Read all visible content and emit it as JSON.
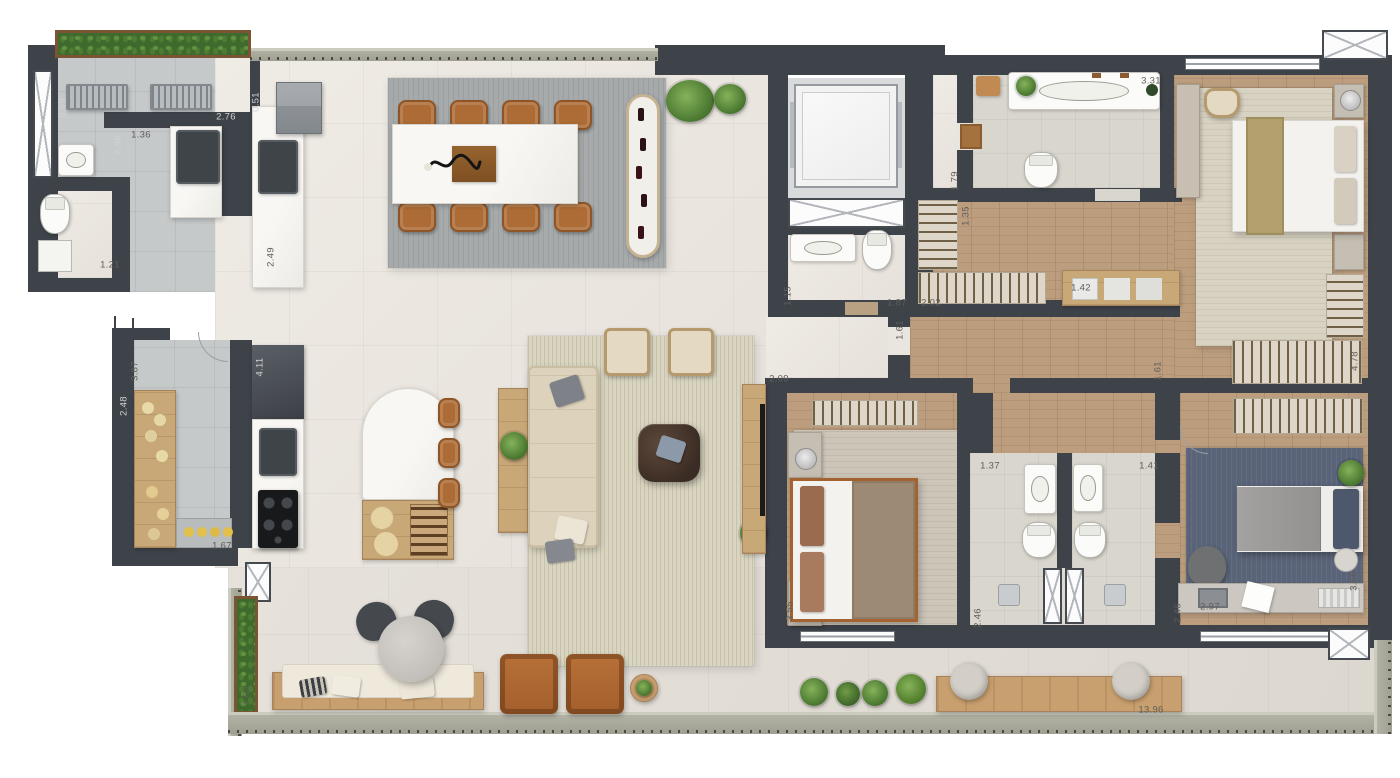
{
  "meta": {
    "type": "apartment-floor-plan-render",
    "view": "top-down-furnished",
    "visible_text_kind": "dimension-annotations-in-meters"
  },
  "palette": {
    "wall": "#3e434a",
    "floor_main_tile": "#eae6e0",
    "floor_service_tile": "#c6c9c9",
    "floor_wood": "#bc9e7f",
    "floor_bath": "#d9d6cd",
    "terrace_tile": "#e2ded7",
    "rug_dining": "#a6aaab",
    "rug_living": "#d9d5c0",
    "rug_bedroom1": "#d8d2c2",
    "rug_bedroom2": "#ccc5b8",
    "rug_bedroom3": "#5a6478",
    "marble": "#f6f5f2",
    "leather_brown": "#b26a33",
    "wood_furniture": "#c9a878",
    "greenery": "#4e7c33",
    "railing": "#a8a89b",
    "appliance_dark": "#3f4449"
  },
  "icons": [
    "planter-icon",
    "drying-rack-icon",
    "laundry-sink-icon",
    "washer-icon",
    "toilet-icon",
    "shower-icon",
    "refrigerator-icon",
    "kitchen-sink-icon",
    "cooktop-icon",
    "pantry-shelf-icon",
    "dining-table-icon",
    "dining-chair-icon",
    "wine-rack-icon",
    "plant-icon",
    "elevator-icon",
    "door-mat-icon",
    "vanity-sink-icon",
    "closet-rack-icon",
    "folded-clothes-icon",
    "double-bed-icon",
    "nightstand-icon",
    "table-lamp-icon",
    "sofa-icon",
    "armchair-icon",
    "coffee-table-icon",
    "console-table-icon",
    "tv-icon",
    "kitchen-island-icon",
    "bar-stool-icon",
    "desk-icon",
    "laptop-icon",
    "lounge-chair-icon",
    "round-table-icon",
    "bench-icon",
    "pouf-icon",
    "side-table-icon",
    "window-icon",
    "shaft-hatch-icon",
    "door-swing-icon",
    "section-cut-icon"
  ],
  "plan": {
    "dimension_labels": [
      {
        "text": "0.69",
        "x": 63,
        "y": 108,
        "rot": -90,
        "tone": "light"
      },
      {
        "text": "2.76",
        "x": 226,
        "y": 117,
        "rot": 0,
        "tone": "light"
      },
      {
        "text": "1.36",
        "x": 141,
        "y": 135,
        "rot": 0,
        "tone": "dark"
      },
      {
        "text": "0.51",
        "x": 256,
        "y": 102,
        "rot": -90,
        "tone": "light"
      },
      {
        "text": "2.06",
        "x": 118,
        "y": 145,
        "rot": -90,
        "tone": "light"
      },
      {
        "text": "2.49",
        "x": 271,
        "y": 257,
        "rot": -90,
        "tone": "dark"
      },
      {
        "text": "1.21",
        "x": 110,
        "y": 265,
        "rot": 0,
        "tone": "dark"
      },
      {
        "text": "3.87",
        "x": 135,
        "y": 371,
        "rot": -90,
        "tone": "dark"
      },
      {
        "text": "2.48",
        "x": 124,
        "y": 406,
        "rot": -90,
        "tone": "light"
      },
      {
        "text": "4.11",
        "x": 260,
        "y": 367,
        "rot": -90,
        "tone": "light"
      },
      {
        "text": "1.67",
        "x": 222,
        "y": 546,
        "rot": 0,
        "tone": "dark"
      },
      {
        "text": "1.79",
        "x": 955,
        "y": 181,
        "rot": -90,
        "tone": "dark"
      },
      {
        "text": "3.31",
        "x": 1151,
        "y": 81,
        "rot": 0,
        "tone": "dark"
      },
      {
        "text": "1.15",
        "x": 788,
        "y": 296,
        "rot": -90,
        "tone": "dark"
      },
      {
        "text": "1.87",
        "x": 897,
        "y": 303,
        "rot": 0,
        "tone": "dark"
      },
      {
        "text": "2.02",
        "x": 931,
        "y": 303,
        "rot": 0,
        "tone": "dark"
      },
      {
        "text": "1.42",
        "x": 1081,
        "y": 288,
        "rot": 0,
        "tone": "dark"
      },
      {
        "text": "1.35",
        "x": 966,
        "y": 216,
        "rot": -90,
        "tone": "dark"
      },
      {
        "text": "1.61",
        "x": 900,
        "y": 330,
        "rot": -90,
        "tone": "dark"
      },
      {
        "text": "2.09",
        "x": 779,
        "y": 379,
        "rot": 0,
        "tone": "dark"
      },
      {
        "text": "1.61",
        "x": 1158,
        "y": 371,
        "rot": -90,
        "tone": "dark"
      },
      {
        "text": "1.37",
        "x": 990,
        "y": 466,
        "rot": 0,
        "tone": "dark"
      },
      {
        "text": "1.41",
        "x": 1149,
        "y": 466,
        "rot": 0,
        "tone": "dark"
      },
      {
        "text": "3.55",
        "x": 790,
        "y": 611,
        "rot": -90,
        "tone": "dark"
      },
      {
        "text": "2.46",
        "x": 978,
        "y": 618,
        "rot": -90,
        "tone": "dark"
      },
      {
        "text": "2.46",
        "x": 1178,
        "y": 613,
        "rot": -90,
        "tone": "dark"
      },
      {
        "text": "2.97",
        "x": 1210,
        "y": 607,
        "rot": 0,
        "tone": "dark"
      },
      {
        "text": "3.55",
        "x": 1354,
        "y": 581,
        "rot": -90,
        "tone": "dark"
      },
      {
        "text": "4.78",
        "x": 1355,
        "y": 361,
        "rot": -90,
        "tone": "dark"
      },
      {
        "text": "1.00",
        "x": 247,
        "y": 696,
        "rot": -90,
        "tone": "dark"
      },
      {
        "text": "13.96",
        "x": 1151,
        "y": 710,
        "rot": 0,
        "tone": "dark"
      }
    ]
  }
}
